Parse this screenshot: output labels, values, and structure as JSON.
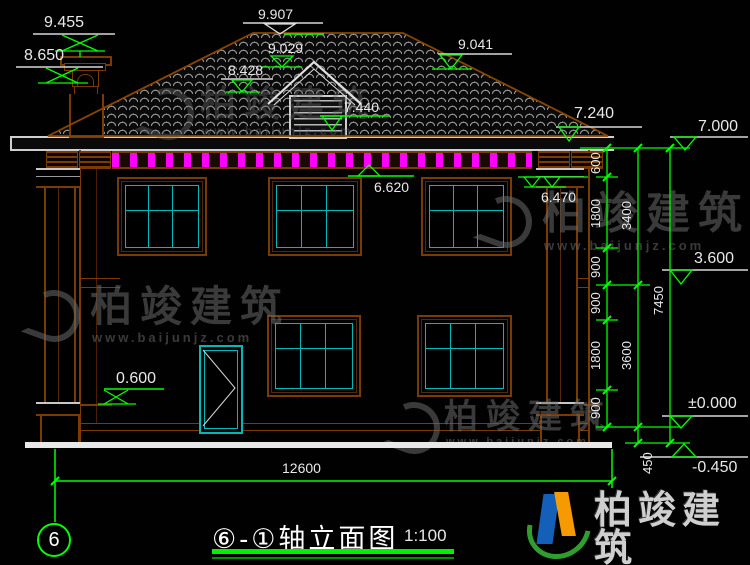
{
  "title_block": {
    "title": "⑥-①轴立面图",
    "scale": "1:100",
    "axis_start": "6"
  },
  "elevations": {
    "chimney_top": "9.455",
    "chimney_cap": "8.650",
    "ridge": "9.907",
    "dormer_ridge": "9.029",
    "dormer_eave": "8.428",
    "dormer_sill": "7.440",
    "roof_right": "9.041",
    "eave_right": "7.240",
    "roof_edge_right": "7.000",
    "fascia_bottom": "6.620",
    "capital_right": "6.470",
    "floor2": "3.600",
    "ground": "±0.000",
    "site": "-0.450",
    "porch": "0.600"
  },
  "dimensions": {
    "right_inner": [
      "600",
      "1800",
      "900",
      "900",
      "1800",
      "900"
    ],
    "right_middle": [
      "3400",
      "3600",
      "450"
    ],
    "right_outer": [
      "7450"
    ],
    "bottom_width": "12600"
  },
  "watermark": {
    "name": "柏竣建筑",
    "url": "www.baijunjz.com"
  },
  "colors": {
    "dim_line": "#00ff00",
    "outline": "#7a3b00",
    "glass": "#00b8b8",
    "dentil": "#ff00ff",
    "text": "#e8e8e8"
  }
}
